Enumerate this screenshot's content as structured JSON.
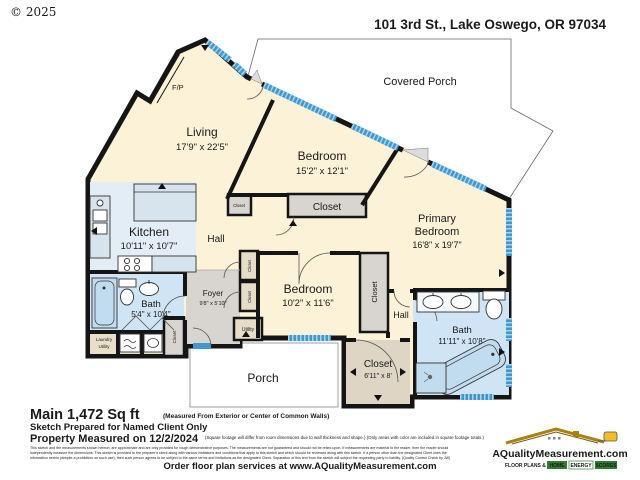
{
  "meta": {
    "copyright": "© 2025",
    "address": "101 3rd St., Lake Oswego, OR 97034"
  },
  "rooms": {
    "covered_porch": {
      "label": "Covered Porch"
    },
    "living": {
      "label": "Living",
      "dims": "17'9\" x 22'5\""
    },
    "bedroom_mid": {
      "label": "Bedroom",
      "dims": "15'2\" x 12'1\""
    },
    "primary": {
      "label_line1": "Primary",
      "label_line2": "Bedroom",
      "dims": "16'8\" x 19'7\""
    },
    "kitchen": {
      "label": "Kitchen",
      "dims": "10'11\" x 10'7\""
    },
    "bedroom_lower": {
      "label": "Bedroom",
      "dims": "10'2\" x 11'6\""
    },
    "bath_left": {
      "label": "Bath",
      "dims": "5'4\" x 10'4\""
    },
    "bath_right": {
      "label": "Bath",
      "dims": "11'11\" x 10'8\""
    },
    "foyer": {
      "label": "Foyer",
      "dims": "9'8\" x 5'10\""
    },
    "hall_left": {
      "label": "Hall"
    },
    "hall_right": {
      "label": "Hall"
    },
    "porch": {
      "label": "Porch"
    },
    "fireplace": {
      "label": "F/P"
    },
    "closet_bedroom_mid": {
      "label": "Closet"
    },
    "closet_living": {
      "label": "Closet"
    },
    "closet_strip": {
      "label": "Closet"
    },
    "closet_left_upper": {
      "label": "Closet"
    },
    "closet_left_lower": {
      "label": "Closet"
    },
    "closet_bath": {
      "label": "Closet"
    },
    "closet_hall": {
      "label": "Closet",
      "dims": "6'11\" x 8'"
    },
    "utility": {
      "label": "Utility"
    },
    "laundry": {
      "label_line1": "Laundry",
      "label_line2": "Utility"
    }
  },
  "footer": {
    "sqft_bold": "Main 1,472 Sq ft",
    "sqft_note": "(Measured From Exterior or Center of Common Walls)",
    "client_line": "Sketch Prepared for Named Client Only",
    "measured_bold": "Property Measured on 12/2/2024",
    "measured_note": "(Square footage will differ from room dimensions due to wall thickness and shape.)  (Only areas with color are included in square footage totals.)",
    "disclaimer_line1": "This sketch and the measurements shown hereon, are approximate and are only provided for rough demonstrative purposes.  The measurements are not guaranteed and should not be relied upon.  If measurements are material to the reader, then the reader should",
    "disclaimer_line2": "independently measure the dimensions.  This sketch is provided to the preparer's client along with various limitations and conditions that apply to this sketch and which should be reviewed along with this sketch.  If a person other than the designated Client uses the",
    "disclaimer_line3": "information herein (despite a prohibition on such use), then such person agrees to be subject to the same terms and limitations as the designated Client.  Separation of this text from the sketch will subject the requesting party to liability.   (Quality Control Check by JW)",
    "order_line": "Order floor plan services at www.AQualityMeasurement.com"
  },
  "logo": {
    "name": "AQualityMeasurement.com",
    "tagline_prefix": "FLOOR PLANS &",
    "tagline_home": "HOME",
    "tagline_energy": "ENERGY",
    "tagline_scores": "SCORES"
  },
  "colors": {
    "wall": "#151515",
    "room_cream": "#fcf2d7",
    "wet_blue": "#cfe4f4",
    "kitchen_blue": "#e2edf5",
    "closet_gray": "#d8d4d0",
    "closet_tan": "#e6dcc8",
    "window_blue": "#3f98d0",
    "logo_navy": "#1a2a80",
    "logo_gold": "#a98113",
    "logo_green": "#2e7d32"
  }
}
